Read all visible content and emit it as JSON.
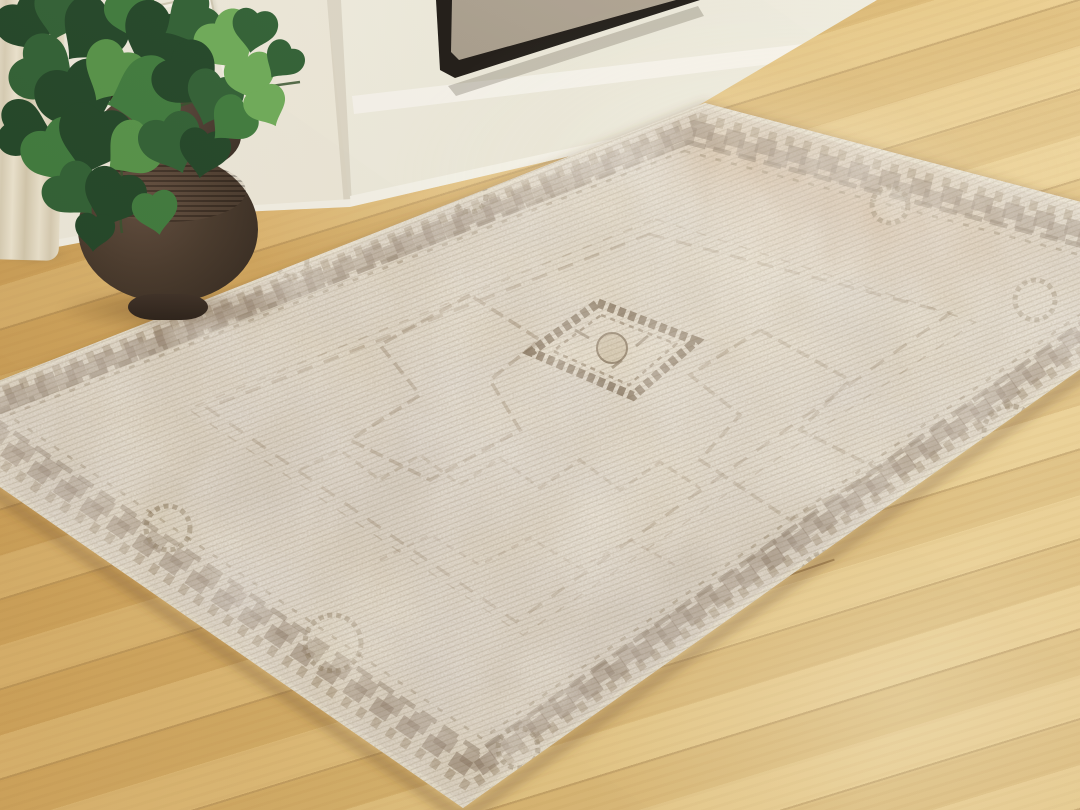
{
  "scene": {
    "type": "product-photography",
    "subject": "distressed vintage-style area rug staged in a living room",
    "objects": [
      "area-rug",
      "oak-hardwood-floor",
      "pothos-plant",
      "brown-ceramic-vase",
      "white-fireplace-surround",
      "framed-artwork",
      "wainscot-panel",
      "linen-curtain"
    ],
    "rug": {
      "style": "distressed traditional medallion",
      "elements": [
        "center-diamond-medallion",
        "geometric-border-bands",
        "rosette-motifs",
        "zigzag-field-motifs",
        "cream-selvedge-edge"
      ]
    },
    "colors": {
      "wall": "#efeadd",
      "surround_white": "#f2f0e4",
      "floor_dark": "#cfa258",
      "floor_mid": "#ddb673",
      "floor_light": "#ecd193",
      "rug_field": "#e3d9c6",
      "rug_cream": "#f0e9d8",
      "rug_taupe": "#bab0a4",
      "rug_brown": "#7b674c",
      "rug_dark_brown": "#5e4d39",
      "rug_rust": "#b27b52",
      "vase_brown": "#46372e",
      "leaf_dark": "#1f4426",
      "leaf_mid": "#3d7a3c",
      "leaf_light": "#6cab57",
      "curtain": "#e6ddc6",
      "frame": "#1b1713",
      "canvas": "#9c9181"
    }
  }
}
